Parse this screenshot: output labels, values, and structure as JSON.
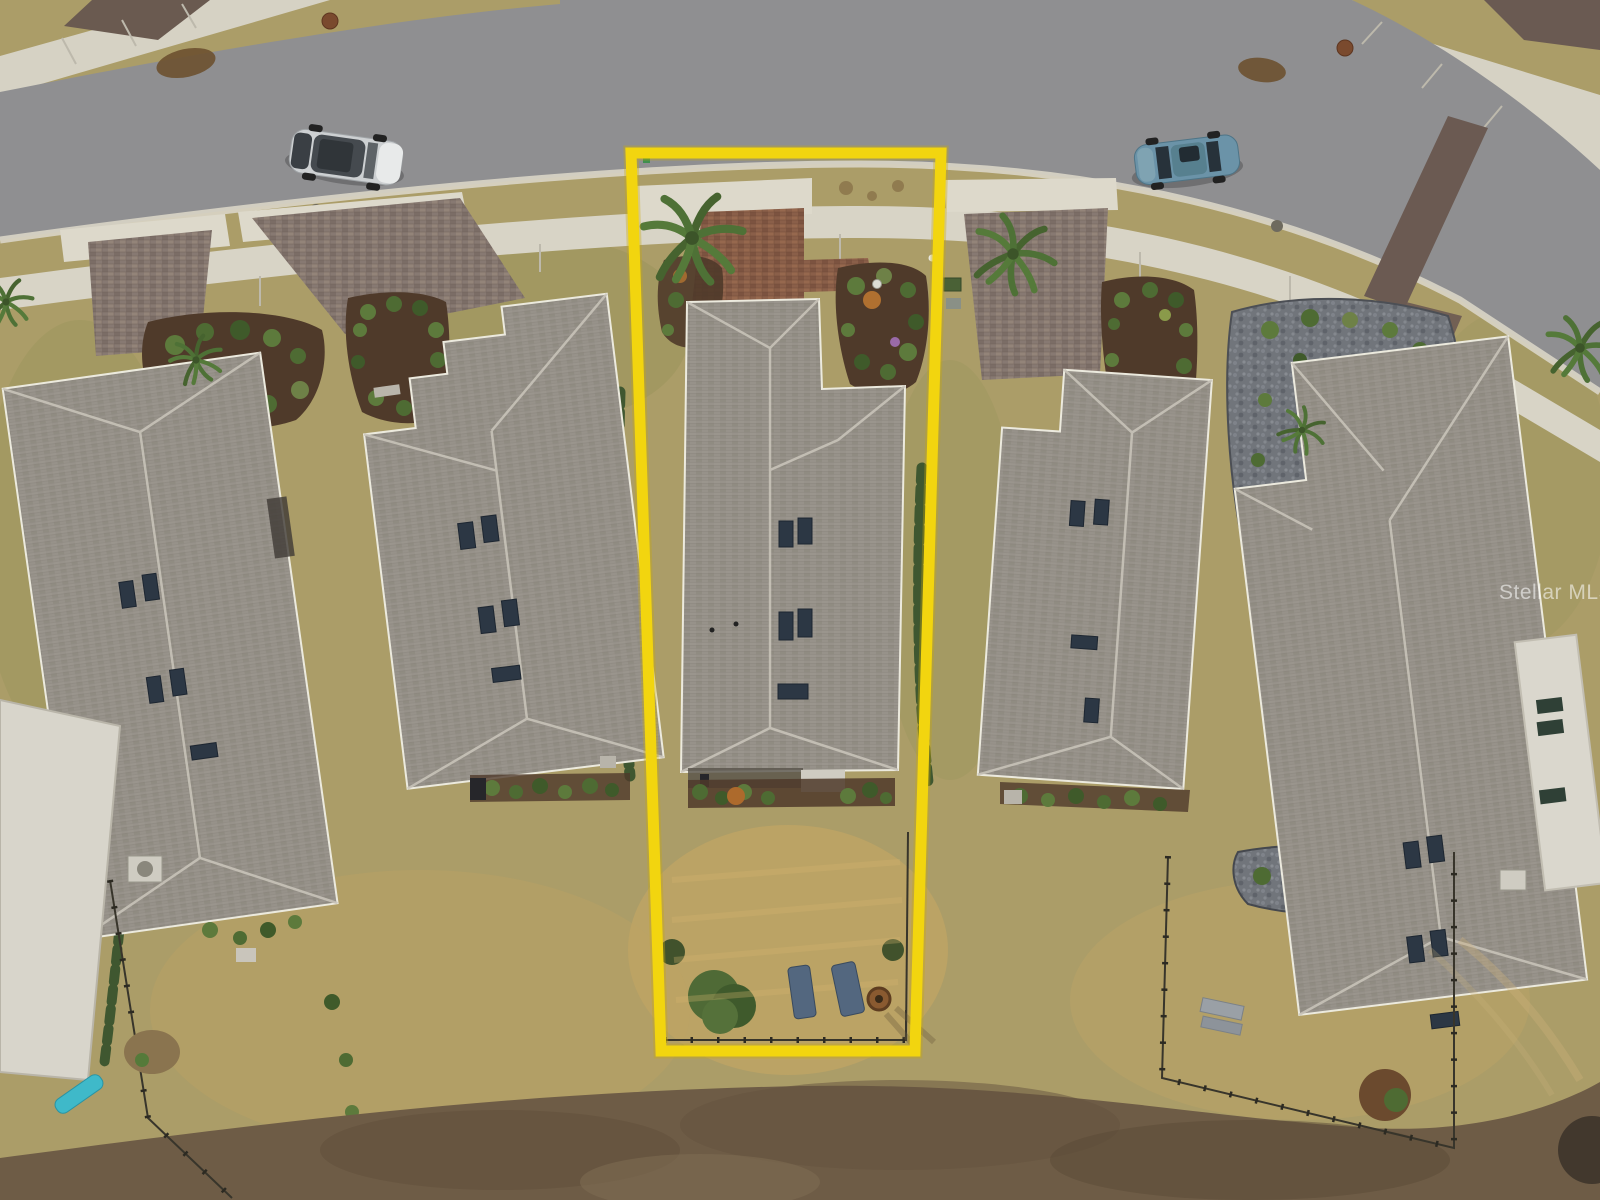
{
  "meta": {
    "kind": "aerial drone photograph, residential neighborhood real-estate listing",
    "width": 1600,
    "height": 1200
  },
  "watermark": {
    "text": "Stellar MLS",
    "color": "#FFFFFF",
    "opacity": 0.55
  },
  "boundary": {
    "label": "highlighted subject lot outline",
    "color": "#F2D50F",
    "shape": "elongated quadrilateral around the center house from street to rear yard"
  },
  "scene": {
    "road": {
      "surface": "asphalt",
      "color": "#8F8F91",
      "curved": true,
      "position": "across top of image"
    },
    "sidewalk_color": "#D8D4C6",
    "ground": {
      "lawn": "#AB9D68",
      "dead_grass": "#C9A763",
      "soil": "#6E5C46"
    },
    "vehicles": [
      {
        "name": "silver-suv",
        "color": "#CDD0D2",
        "parked": "street, upper left"
      },
      {
        "name": "teal-sedan",
        "color": "#6B93A8",
        "parked": "street, upper right"
      }
    ],
    "houses": [
      {
        "name": "house-far-left",
        "roof_color": "#97928A",
        "skylights": 5
      },
      {
        "name": "house-left",
        "roof_color": "#959088",
        "skylights": 5
      },
      {
        "name": "house-subject",
        "roof_color": "#928D85",
        "skylights": 5,
        "highlighted": true
      },
      {
        "name": "house-right",
        "roof_color": "#959088",
        "skylights": 4
      },
      {
        "name": "house-far-right",
        "roof_color": "#938E86",
        "skylights": 5
      }
    ],
    "subject_lot": {
      "front": [
        "concrete apron",
        "red paver driveway",
        "palm tree",
        "mulch garden bed with shrubs"
      ],
      "rear": [
        "patio",
        "shrub row",
        "large bush",
        "two lounge chairs",
        "fire pit",
        "low fence"
      ],
      "chair_color": "#53677F",
      "fire_pit_color": "#8A5A30"
    },
    "other_items": [
      "wire fenced backyards",
      "picnic bench",
      "rock landscaping beds",
      "teal yard object",
      "manhole covers",
      "utility boxes",
      "AC units"
    ]
  }
}
